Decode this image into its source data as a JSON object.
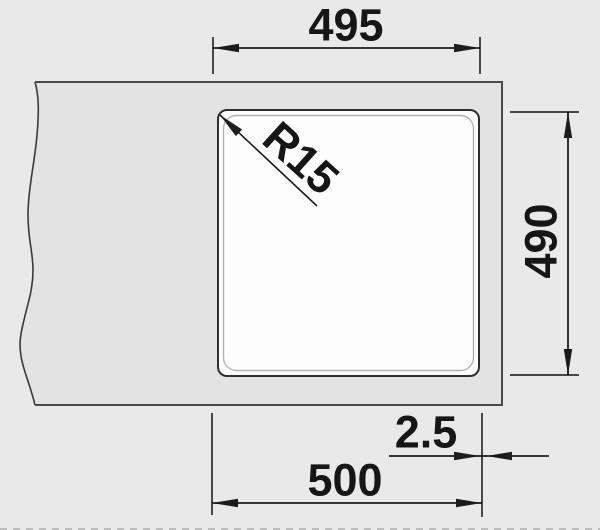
{
  "drawing": {
    "type": "technical-dimension-drawing",
    "subject": "built-in sink bowl cut-out, top view",
    "labels": {
      "top_width": "495",
      "side_height": "490",
      "corner_radius": "R15",
      "edge_gap": "2.5",
      "overall_width": "500"
    },
    "colors": {
      "background": "#e9e9e9",
      "worktop": "#e3e3e3",
      "bowl": "#fdfdfd",
      "line": "#2e2e2e",
      "inner_edge": "#b2b2b2"
    }
  }
}
